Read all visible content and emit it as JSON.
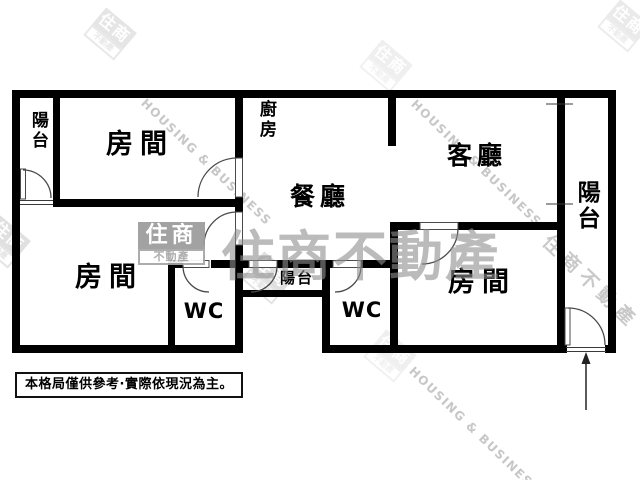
{
  "rooms": {
    "room_top_left": "房間",
    "room_bottom_left": "房間",
    "room_bottom_right": "房間",
    "living": "客廳",
    "dining": "餐廳",
    "kitchen": "廚房",
    "balcony_left": "陽台",
    "balcony_mid": "陽台",
    "balcony_right": "陽台",
    "wc1": "WC",
    "wc2": "WC"
  },
  "disclaimer": {
    "text": "本格局僅供參考·實際依現況為主。"
  },
  "watermark": {
    "brand_cjk": "住商不動產",
    "brand_en": "HOUSING & BUSINESS",
    "logo_top": "住商",
    "logo_bottom": "不動產"
  },
  "colors": {
    "wall": "#000000",
    "background": "#ffffff",
    "watermark_gray": "#8f8f8f",
    "watermark_light": "#c7c7c7"
  }
}
